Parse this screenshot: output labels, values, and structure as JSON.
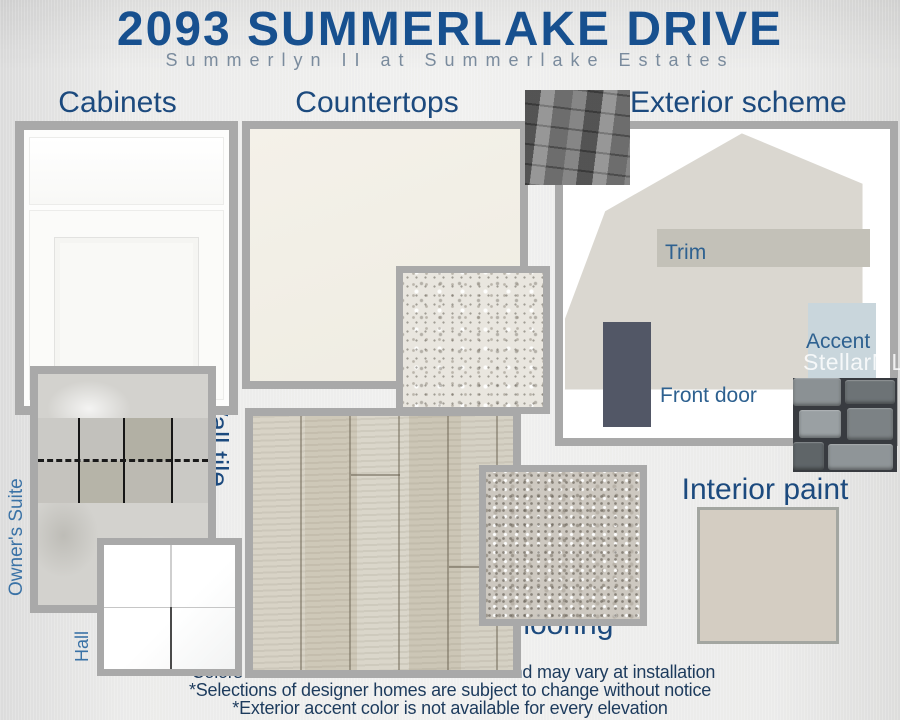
{
  "header": {
    "title": "2093 SUMMERLAKE DRIVE",
    "subtitle": "Summerlyn II at Summerlake Estates"
  },
  "sections": {
    "cabinets": {
      "label": "Cabinets"
    },
    "countertops": {
      "label": "Countertops",
      "kitchen": "Kitchen",
      "bathroom": "Bathroom"
    },
    "exterior": {
      "label": "Exterior scheme",
      "trim": "Trim",
      "front_door": "Front door",
      "accent": "Accent",
      "watermark": "StellarMLS"
    },
    "wall_tile": {
      "label": "Wall tile",
      "owners_suite": "Owner's Suite",
      "hall": "Hall"
    },
    "flooring": {
      "label": "Flooring"
    },
    "interior_paint": {
      "label": "Interior paint"
    }
  },
  "footnotes": [
    "*Colors are direct from the manufacturer and may vary at installation",
    "*Selections of designer homes are subject to change without notice",
    "*Exterior accent color is not available for every elevation"
  ],
  "colors": {
    "title_blue": "#17508f",
    "subtitle_gray_blue": "#7a8b9d",
    "section_label_blue": "#1c4a7e",
    "annotation_blue": "#2e6190",
    "footnote_navy": "#1d3b5d",
    "sample_frame_gray": "#a9a9a9",
    "house_body": "#dad7d0",
    "trim_swatch": "#c3c1b8",
    "front_door_swatch": "#525766",
    "accent_swatch": "#c9d6dc",
    "interior_paint_swatch": "#d4cdc2",
    "kitchen_countertop": "#f2efe7"
  }
}
